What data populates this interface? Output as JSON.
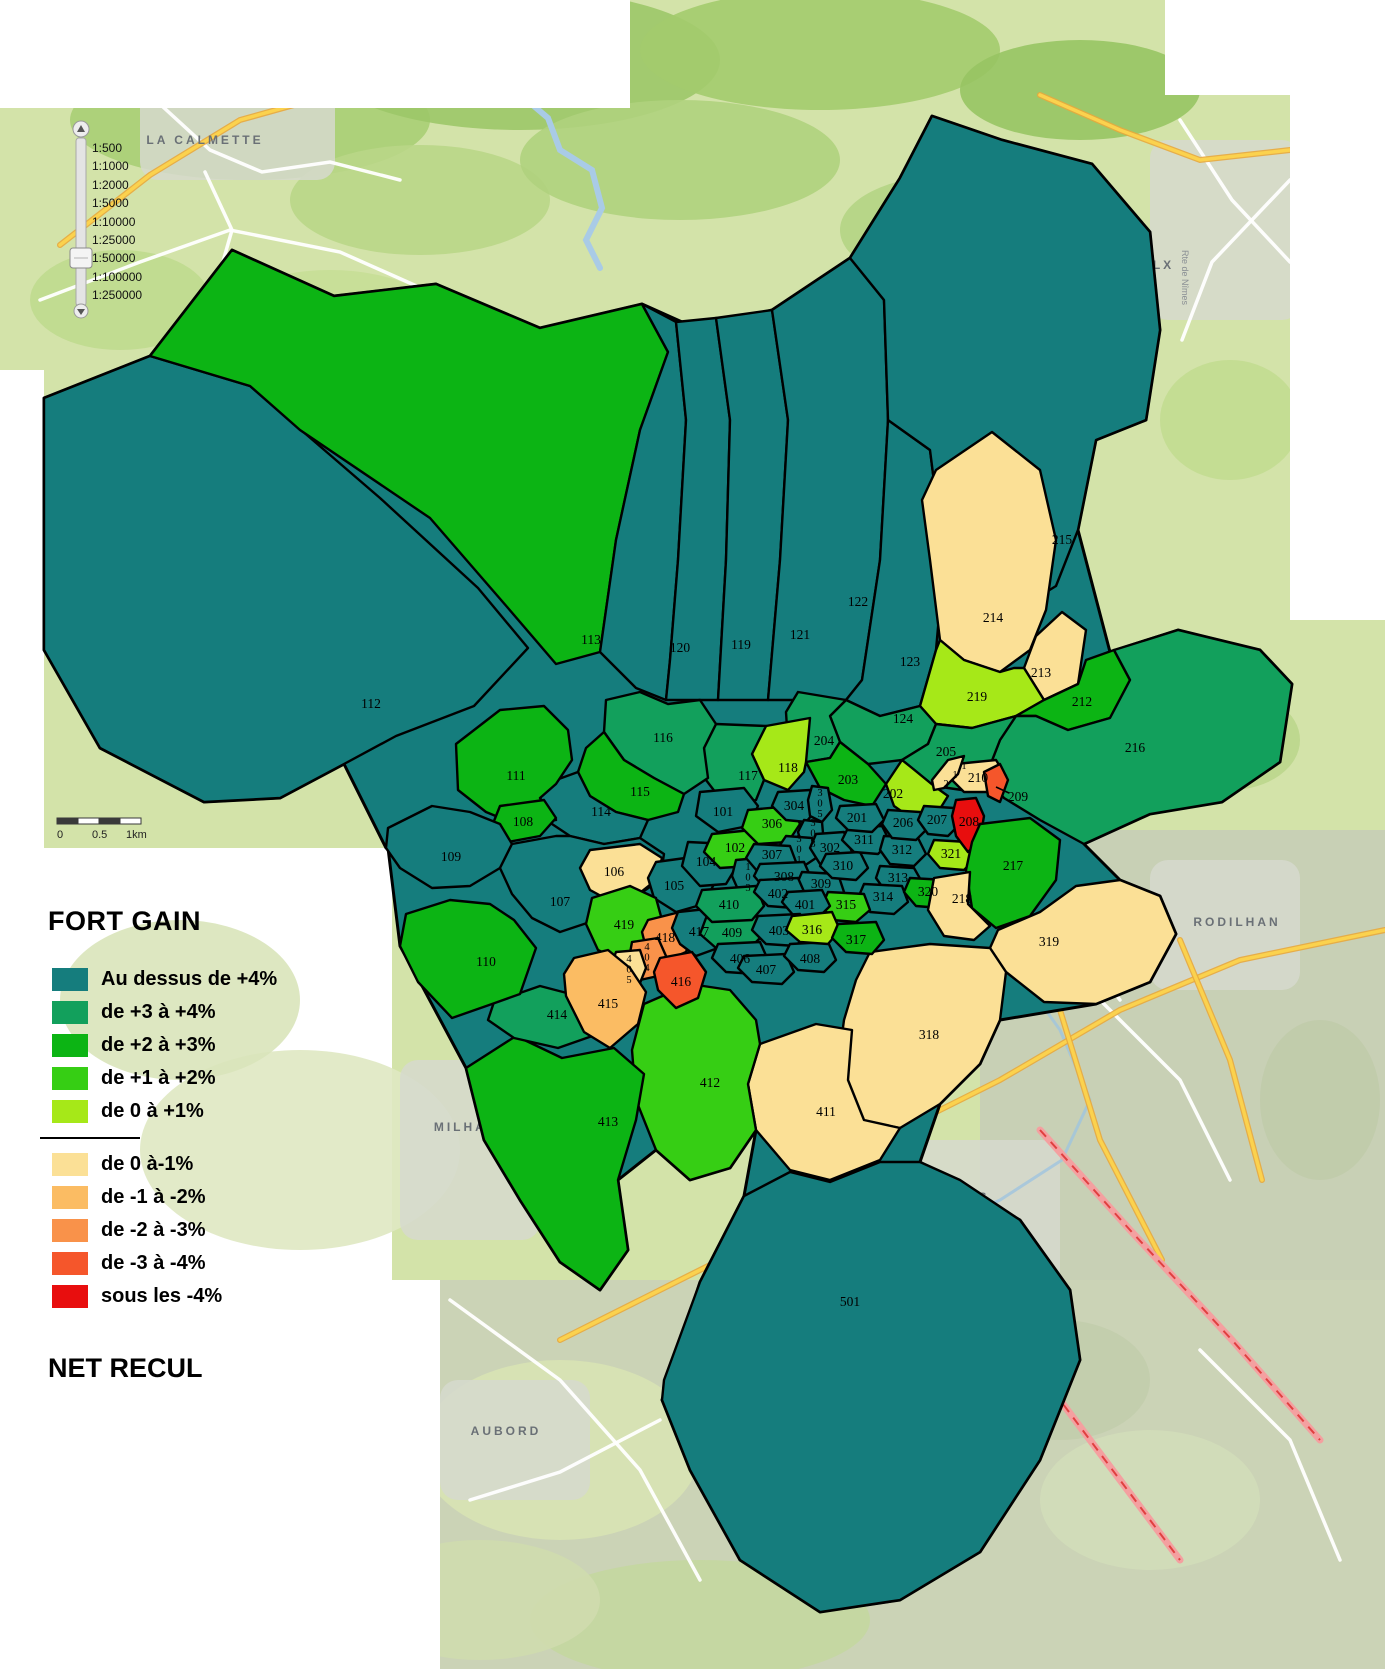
{
  "legend": {
    "title": "FORT GAIN",
    "footer": "NET RECUL",
    "positive": [
      {
        "label": "Au dessus de +4%",
        "color": "#157D7D"
      },
      {
        "label": "de +3 à +4%",
        "color": "#12A05C"
      },
      {
        "label": "de +2 à +3%",
        "color": "#0CB414"
      },
      {
        "label": "de +1 à +2%",
        "color": "#36CE14"
      },
      {
        "label": "de 0 à +1%",
        "color": "#A6E818"
      }
    ],
    "negative": [
      {
        "label": "de 0 à-1%",
        "color": "#FBE096"
      },
      {
        "label": "de -1 à -2%",
        "color": "#FBBC63"
      },
      {
        "label": "de -2 à -3%",
        "color": "#F9924A"
      },
      {
        "label": "de -3 à -4%",
        "color": "#F5562B"
      },
      {
        "label": "sous les -4%",
        "color": "#E80E0E"
      }
    ]
  },
  "scale_slider": {
    "levels": [
      "1:500",
      "1:1000",
      "1:2000",
      "1:5000",
      "1:10000",
      "1:25000",
      "1:50000",
      "1:100000",
      "1:250000"
    ],
    "selected": "1:50000"
  },
  "scale_bar": {
    "labels": [
      "0",
      "0.5",
      "1km"
    ]
  },
  "map": {
    "categories": {
      "gt4": "#157D7D",
      "p34": "#12A05C",
      "p23": "#0CB414",
      "p12": "#36CE14",
      "p01": "#A6E818",
      "m01": "#FBE096",
      "m12": "#FBBC63",
      "m23": "#F9924A",
      "m34": "#F5562B",
      "lt4": "#E80E0E"
    },
    "towns": [
      {
        "name": "LA CALMETTE",
        "x": 205,
        "y": 144
      },
      {
        "name": "POULX",
        "x": 1146,
        "y": 269
      },
      {
        "name": "RODILHAN",
        "x": 1237,
        "y": 926
      },
      {
        "name": "CAISSARGUES",
        "x": 929,
        "y": 1201
      },
      {
        "name": "MILHAUD",
        "x": 472,
        "y": 1131
      },
      {
        "name": "AUBORD",
        "x": 506,
        "y": 1435
      }
    ],
    "road_labels": [
      {
        "name": "Rte de Nîmes",
        "x": 1182,
        "y": 250,
        "rot": 90
      }
    ],
    "base_outline": "232,250 334,296 436,284 540,328 642,304 700,330 772,310 850,258 900,178 932,116 1002,140 1092,164 1150,232 1160,330 1146,420 1096,440 1078,530 1110,652 1178,630 1260,650 1292,684 1280,762 1222,802 1150,814 1084,844 1120,880 1160,896 1176,934 1150,982 1096,1004 1000,1020 980,1064 940,1104 920,1162 1020,1220 1070,1290 1080,1360 1040,1460 980,1552 900,1600 820,1612 740,1560 690,1470 662,1400 700,1282 744,1196 756,1130 730,1168 690,1180 656,1150 618,1180 628,1250 600,1290 560,1262 520,1200 484,1140 466,1068 420,982 400,946 388,848 386,848 344,764 280,798 204,802 100,748 44,650 44,398 150,356",
    "leader_209": {
      "x1": 1009,
      "y1": 793,
      "x2": 996,
      "y2": 787
    },
    "zones": [
      {
        "id": "112",
        "cat": "gt4",
        "x": 371,
        "y": 704,
        "pts": "44,398 150,356 250,386 380,498 478,588 528,648 474,706 396,736 344,764 280,798 204,802 100,748 44,650"
      },
      {
        "id": "113",
        "cat": "p23",
        "x": 591,
        "y": 640,
        "pts": "150,356 232,250 334,296 436,284 540,328 642,304 668,352 640,430 616,540 600,652 556,664 508,608 430,518 300,430 250,386"
      },
      {
        "id": "120",
        "cat": "gt4",
        "x": 680,
        "y": 648,
        "pts": "642,304 676,322 686,420 678,560 670,660 666,700 636,688 600,652 616,540 640,430 668,352"
      },
      {
        "id": "119",
        "cat": "gt4",
        "x": 741,
        "y": 645,
        "pts": "676,322 716,318 730,420 726,560 718,700 666,700 670,660 678,560 686,420"
      },
      {
        "id": "121",
        "cat": "gt4",
        "x": 800,
        "y": 635,
        "pts": "716,318 772,310 788,420 780,560 768,700 718,700 726,560 730,420"
      },
      {
        "id": "122",
        "cat": "gt4",
        "x": 858,
        "y": 602,
        "pts": "772,310 850,258 884,300 888,420 880,560 862,680 846,700 768,700 780,560 788,420"
      },
      {
        "id": "123",
        "cat": "gt4",
        "x": 910,
        "y": 662,
        "pts": "888,420 930,450 944,560 936,650 920,706 880,716 846,700 862,680 880,560"
      },
      {
        "id": "215",
        "cat": "gt4",
        "x": 1062,
        "y": 540,
        "pts": "850,258 900,178 932,116 1002,140 1092,164 1150,232 1160,330 1146,420 1096,440 1078,530 1056,586 1014,612 968,588 944,560 930,450 888,420 884,300"
      },
      {
        "id": "214",
        "cat": "m01",
        "x": 993,
        "y": 618,
        "pts": "936,470 992,432 1040,470 1056,540 1046,610 1030,650 1000,672 964,660 940,640 930,560 922,500"
      },
      {
        "id": "213",
        "cat": "m01",
        "x": 1041,
        "y": 673,
        "pts": "1036,636 1062,612 1086,630 1078,684 1044,700 1024,668"
      },
      {
        "id": "219",
        "cat": "p01",
        "x": 977,
        "y": 697,
        "pts": "920,706 936,650 940,640 964,660 1000,672 1014,668 1024,668 1044,700 1016,716 972,728 936,724"
      },
      {
        "id": "212",
        "cat": "p23",
        "x": 1082,
        "y": 702,
        "pts": "1044,700 1078,684 1086,660 1114,650 1130,680 1110,718 1068,730 1036,716 1016,716"
      },
      {
        "id": "216",
        "cat": "p34",
        "x": 1135,
        "y": 748,
        "pts": "1114,650 1178,630 1260,650 1292,684 1280,762 1222,802 1150,814 1084,844 1040,820 1004,798 986,776 1000,740 1016,716 1036,716 1068,730 1110,718 1130,680"
      },
      {
        "id": "124",
        "cat": "p34",
        "x": 903,
        "y": 719,
        "pts": "846,700 880,716 920,706 936,724 928,744 902,760 868,764 840,742 830,716"
      },
      {
        "id": "205",
        "cat": "p34",
        "x": 946,
        "y": 752,
        "pts": "928,744 936,724 972,728 1016,716 1000,740 986,776 962,790 934,786 912,768 902,760"
      },
      {
        "id": "204",
        "cat": "p34",
        "x": 824,
        "y": 741,
        "pts": "798,692 846,700 830,716 840,742 830,758 806,762 788,744 786,712"
      },
      {
        "id": "203",
        "cat": "p23",
        "x": 848,
        "y": 780,
        "pts": "830,758 840,742 868,764 886,784 872,806 844,800 820,788 806,762"
      },
      {
        "id": "202",
        "cat": "p01",
        "x": 893,
        "y": 794,
        "pts": "886,784 902,760 912,768 934,786 948,796 938,812 914,820 894,806"
      },
      {
        "id": "118",
        "cat": "p01",
        "x": 788,
        "y": 768,
        "pts": "766,726 810,718 806,762 804,772 788,790 764,780 752,754"
      },
      {
        "id": "117",
        "cat": "p34",
        "x": 748,
        "y": 776,
        "pts": "716,724 766,726 752,754 764,780 756,800 726,806 706,780 704,748"
      },
      {
        "id": "116",
        "cat": "p34",
        "x": 663,
        "y": 738,
        "pts": "606,700 640,692 668,704 700,700 716,724 704,748 708,778 684,794 654,778 624,760 604,732"
      },
      {
        "id": "115",
        "cat": "p23",
        "x": 640,
        "y": 792,
        "pts": "604,732 624,760 654,778 684,794 678,812 648,820 616,812 590,796 578,772 586,748"
      },
      {
        "id": "114",
        "cat": "gt4",
        "x": 601,
        "y": 812,
        "pts": "578,772 590,796 616,812 648,820 640,838 604,844 570,836 546,820 540,798 556,780"
      },
      {
        "id": "111",
        "cat": "p23",
        "x": 516,
        "y": 776,
        "pts": "456,744 500,710 544,706 568,730 572,760 556,784 540,798 556,820 520,826 486,812 458,790"
      },
      {
        "id": "108",
        "cat": "p23",
        "x": 523,
        "y": 822,
        "pts": "500,806 544,800 556,818 540,836 508,842 492,826"
      },
      {
        "id": "109",
        "cat": "gt4",
        "x": 451,
        "y": 857,
        "pts": "388,828 432,806 470,812 500,824 512,844 500,868 470,886 432,888 400,868 386,848"
      },
      {
        "id": "107",
        "cat": "gt4",
        "x": 560,
        "y": 902,
        "pts": "512,844 556,836 570,836 604,844 640,838 664,854 660,880 628,902 596,920 560,932 532,918 512,894 500,868"
      },
      {
        "id": "106",
        "cat": "m01",
        "x": 614,
        "y": 872,
        "pts": "590,850 640,844 662,858 656,880 636,896 612,902 590,890 580,868"
      },
      {
        "id": "105",
        "cat": "gt4",
        "x": 674,
        "y": 886,
        "pts": "656,862 700,856 716,880 704,904 676,912 654,898 648,878"
      },
      {
        "id": "104",
        "cat": "gt4",
        "x": 706,
        "y": 862,
        "pts": "688,842 728,844 738,864 726,884 700,886 682,866"
      },
      {
        "id": "101",
        "cat": "gt4",
        "x": 723,
        "y": 812,
        "pts": "700,792 744,788 758,806 748,826 718,832 696,816"
      },
      {
        "id": "102",
        "cat": "p12",
        "x": 735,
        "y": 848,
        "pts": "712,834 752,830 762,848 750,866 720,868 704,852"
      },
      {
        "id": "103",
        "cat": "gt4",
        "o": "v",
        "x": 748,
        "y": 870,
        "pts": "736,860 758,858 764,886 754,898 740,894 732,876"
      },
      {
        "id": "306",
        "cat": "p12",
        "x": 772,
        "y": 824,
        "pts": "748,810 792,806 800,824 788,842 758,844 742,828"
      },
      {
        "id": "304",
        "cat": "gt4",
        "x": 794,
        "y": 806,
        "pts": "778,792 810,790 818,808 806,822 786,820 772,806"
      },
      {
        "id": "305",
        "cat": "gt4",
        "o": "v",
        "x": 820,
        "y": 796,
        "pts": "812,786 828,788 832,810 822,822 810,816 808,800"
      },
      {
        "id": "303",
        "cat": "gt4",
        "o": "v",
        "x": 813,
        "y": 826,
        "pts": "804,820 822,822 824,844 814,852 802,846 798,832"
      },
      {
        "id": "301",
        "cat": "gt4",
        "o": "v",
        "x": 799,
        "y": 842,
        "pts": "786,836 812,838 816,858 804,866 786,862 778,848"
      },
      {
        "id": "302",
        "cat": "gt4",
        "x": 830,
        "y": 848,
        "pts": "816,834 844,832 852,852 840,866 820,864 810,848"
      },
      {
        "id": "307",
        "cat": "gt4",
        "x": 772,
        "y": 855,
        "pts": "754,844 790,846 796,862 784,874 758,872 746,858"
      },
      {
        "id": "308",
        "cat": "gt4",
        "x": 784,
        "y": 877,
        "pts": "760,864 804,862 812,880 798,894 768,892 754,876"
      },
      {
        "id": "309",
        "cat": "gt4",
        "x": 821,
        "y": 884,
        "pts": "802,872 838,874 844,892 830,902 806,900 796,886"
      },
      {
        "id": "310",
        "cat": "gt4",
        "x": 843,
        "y": 866,
        "pts": "826,854 860,852 868,868 856,880 832,878 820,866"
      },
      {
        "id": "311",
        "cat": "gt4",
        "x": 864,
        "y": 840,
        "pts": "848,828 882,826 890,842 878,854 854,852 842,840"
      },
      {
        "id": "312",
        "cat": "gt4",
        "x": 902,
        "y": 850,
        "pts": "884,836 918,838 926,854 914,866 890,864 880,850"
      },
      {
        "id": "313",
        "cat": "gt4",
        "x": 898,
        "y": 878,
        "pts": "880,866 914,868 922,882 910,894 886,892 876,878"
      },
      {
        "id": "314",
        "cat": "gt4",
        "x": 883,
        "y": 897,
        "pts": "864,884 902,886 908,902 894,914 870,912 858,898"
      },
      {
        "id": "315",
        "cat": "p12",
        "x": 846,
        "y": 905,
        "pts": "828,892 864,894 870,910 856,922 832,920 822,906"
      },
      {
        "id": "321",
        "cat": "p01",
        "x": 951,
        "y": 854,
        "pts": "934,840 968,842 976,858 964,870 940,868 928,854"
      },
      {
        "id": "320",
        "cat": "p23",
        "x": 928,
        "y": 892,
        "pts": "910,878 946,880 954,896 940,908 916,906 904,892"
      },
      {
        "id": "201",
        "cat": "gt4",
        "x": 857,
        "y": 818,
        "pts": "840,806 876,804 884,820 872,832 848,830 836,818"
      },
      {
        "id": "206",
        "cat": "gt4",
        "x": 903,
        "y": 823,
        "pts": "888,810 920,812 928,828 916,840 892,838 882,824"
      },
      {
        "id": "207",
        "cat": "gt4",
        "x": 937,
        "y": 820,
        "pts": "924,806 954,808 960,824 948,836 928,834 918,820"
      },
      {
        "id": "210",
        "cat": "m01",
        "x": 978,
        "y": 778,
        "pts": "956,764 996,760 1006,776 992,792 964,792 950,778"
      },
      {
        "id": "211",
        "cat": "m01",
        "o": "d",
        "x": 946,
        "y": 787,
        "pts": "932,780 948,760 964,756 958,774 944,788 934,790"
      },
      {
        "id": "209",
        "cat": "m34",
        "x": 1018,
        "y": 797,
        "pts": "984,772 1000,764 1008,780 1000,802 988,796"
      },
      {
        "id": "208",
        "cat": "lt4",
        "x": 969,
        "y": 822,
        "pts": "956,800 976,798 984,816 980,840 968,852 956,836 952,816"
      },
      {
        "id": "217",
        "cat": "p23",
        "x": 1013,
        "y": 866,
        "pts": "980,824 1030,818 1060,840 1056,880 1030,916 996,928 972,908 966,870 972,842"
      },
      {
        "id": "218",
        "cat": "m01",
        "x": 962,
        "y": 899,
        "pts": "934,878 970,872 968,904 990,926 974,940 944,936 928,910"
      },
      {
        "id": "319",
        "cat": "m01",
        "x": 1049,
        "y": 942,
        "pts": "998,930 1040,912 1076,886 1120,880 1160,896 1176,934 1150,982 1096,1004 1044,1002 1006,972 990,948"
      },
      {
        "id": "318",
        "cat": "m01",
        "x": 929,
        "y": 1035,
        "pts": "870,952 930,944 990,948 1006,972 1000,1020 980,1064 940,1104 900,1128 860,1120 836,1080 844,1020 856,980"
      },
      {
        "id": "411",
        "cat": "m01",
        "x": 826,
        "y": 1112,
        "pts": "760,1044 816,1024 852,1030 848,1080 864,1120 900,1128 880,1160 830,1180 790,1170 756,1130 748,1084"
      },
      {
        "id": "412",
        "cat": "p12",
        "x": 710,
        "y": 1083,
        "pts": "644,1004 690,984 730,990 756,1020 760,1044 748,1084 756,1130 730,1168 690,1180 656,1150 636,1100 632,1050"
      },
      {
        "id": "413",
        "cat": "p23",
        "x": 608,
        "y": 1122,
        "pts": "466,1068 516,1036 562,1058 614,1048 644,1074 636,1120 618,1180 628,1250 600,1290 560,1262 520,1200 484,1140"
      },
      {
        "id": "414",
        "cat": "p34",
        "x": 557,
        "y": 1015,
        "pts": "494,1002 540,986 586,998 616,1012 598,1034 558,1048 514,1038 488,1020"
      },
      {
        "id": "110",
        "cat": "p23",
        "x": 486,
        "y": 962,
        "pts": "406,914 450,900 490,904 514,920 536,948 520,994 492,1004 452,1018 418,982 400,946"
      },
      {
        "id": "419",
        "cat": "p12",
        "x": 624,
        "y": 925,
        "pts": "592,898 630,886 656,898 662,920 648,946 622,962 598,950 586,924"
      },
      {
        "id": "418",
        "cat": "m23",
        "x": 665,
        "y": 938,
        "pts": "648,920 680,912 694,930 686,952 664,962 646,948 642,932"
      },
      {
        "id": "417",
        "cat": "gt4",
        "x": 699,
        "y": 932,
        "pts": "678,912 716,908 728,926 718,948 696,956 680,944 672,928"
      },
      {
        "id": "404",
        "cat": "m23",
        "o": "v",
        "x": 647,
        "y": 950,
        "pts": "632,942 658,938 666,956 658,976 640,980 628,964"
      },
      {
        "id": "405",
        "cat": "m01",
        "o": "v",
        "x": 629,
        "y": 962,
        "pts": "616,952 640,950 646,968 638,988 620,992 608,974"
      },
      {
        "id": "416",
        "cat": "m34",
        "x": 681,
        "y": 982,
        "pts": "660,958 692,952 706,972 698,998 676,1008 658,990 654,972"
      },
      {
        "id": "415",
        "cat": "m12",
        "x": 608,
        "y": 1004,
        "pts": "574,958 608,950 630,968 646,992 638,1024 610,1048 584,1032 566,996 564,974"
      },
      {
        "id": "409",
        "cat": "p34",
        "x": 732,
        "y": 933,
        "pts": "706,918 756,914 762,936 748,950 716,948 700,934"
      },
      {
        "id": "410",
        "cat": "p34",
        "x": 729,
        "y": 905,
        "pts": "702,890 756,886 764,906 752,920 712,922 696,906"
      },
      {
        "id": "402",
        "cat": "gt4",
        "x": 778,
        "y": 894,
        "pts": "760,880 798,878 806,896 794,908 768,906 754,892"
      },
      {
        "id": "401",
        "cat": "gt4",
        "x": 805,
        "y": 905,
        "pts": "788,892 822,890 830,906 818,918 794,916 782,902"
      },
      {
        "id": "403",
        "cat": "gt4",
        "x": 779,
        "y": 931,
        "pts": "758,916 800,914 808,932 796,946 766,944 752,930"
      },
      {
        "id": "406",
        "cat": "gt4",
        "x": 740,
        "y": 959,
        "pts": "718,944 760,942 768,960 756,974 726,972 712,958"
      },
      {
        "id": "407",
        "cat": "gt4",
        "x": 766,
        "y": 970,
        "pts": "744,956 786,954 794,972 782,984 752,982 738,968"
      },
      {
        "id": "408",
        "cat": "gt4",
        "x": 810,
        "y": 959,
        "pts": "790,944 828,942 836,960 824,972 798,970 784,956"
      },
      {
        "id": "316",
        "cat": "p01",
        "x": 812,
        "y": 930,
        "pts": "792,916 832,912 840,930 828,944 800,942 786,930"
      },
      {
        "id": "317",
        "cat": "p23",
        "x": 856,
        "y": 940,
        "pts": "838,924 876,922 884,940 872,954 846,952 832,938"
      },
      {
        "id": "501",
        "cat": "gt4",
        "x": 850,
        "y": 1302,
        "pts": "664,1380 700,1282 744,1196 790,1172 830,1182 880,1162 920,1162 960,1180 1020,1220 1070,1290 1080,1360 1040,1460 980,1552 900,1600 820,1612 740,1560 690,1470 662,1400"
      }
    ]
  }
}
